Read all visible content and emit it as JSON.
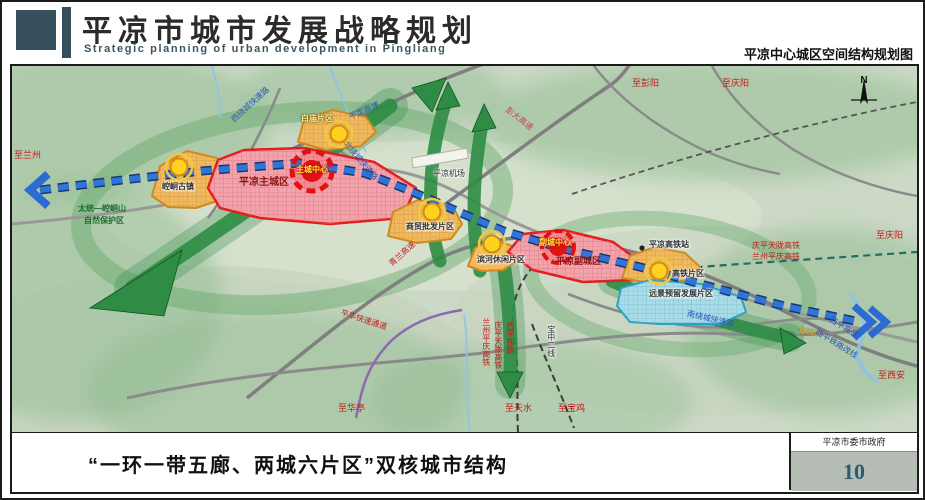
{
  "header": {
    "title": "平凉市城市发展战略规划",
    "subtitle": "Strategic planning of urban development in Pingliang",
    "map_title": "平凉中心城区空间结构规划图"
  },
  "footer": {
    "caption": "“一环一带五廊、两城六片区”双核城市结构",
    "authority": "平凉市委市政府",
    "page_number": "10"
  },
  "map": {
    "compass": "N",
    "labels": {
      "to_lanzhou": "至兰州",
      "nature_reserve_1": "太统—崆峒山",
      "nature_reserve_2": "自然保护区",
      "kongtong_zone": "崆峒古镇",
      "main_city": "平凉主城区",
      "main_center": "主城中心",
      "baimiao_zone": "白庙片区",
      "west_ring_rd": "西绕城快速路",
      "pingding_expwy": "平定高速",
      "pengda_expwy": "彭大高速",
      "to_pengyang": "至彭阳",
      "to_qingyang_top": "至庆阳",
      "airport": "平凉机场",
      "north_ring_rd": "北绕城快速路",
      "trade_zone": "商贸批发片区",
      "qinglan_expwy": "青兰高速",
      "leisure_zone": "滨河休闲片区",
      "sub_city": "平凉副城区",
      "sub_center": "副城中心",
      "hsr_station": "平凉高铁站",
      "qptl_hsr": "庆平天陇高铁",
      "lzpq_hsr": "兰州平庆高铁",
      "to_qingyang_right": "至庆阳",
      "hsr_zone": "高铁片区",
      "reserved_zone": "远景预留发展片区",
      "south_ring_rd": "南绕城快速路",
      "pinghua_rd": "平华快速通道",
      "to_huating": "至华亭",
      "lzpq_hsr_v": "兰州平庆高铁",
      "qptl_hsr_v": "庆平天陇高铁",
      "xiping_rail_v": "西平铁路",
      "baozhong_line": "宝中二线",
      "to_tianshui": "至天水",
      "to_baoji": "至宝鸡",
      "g312": "G312",
      "xiping_expwy": "西平高速",
      "xiping_rail_reroute": "西平铁路改线",
      "to_xian": "至西安"
    },
    "colors": {
      "accent_teal": "#35505c",
      "corridor_green": "#2e8c44",
      "transit_blue": "#2f74d6",
      "city_red": "#e31c1c",
      "district_orange": "#f0b95e",
      "reserved_blue": "#aadce8",
      "center_yellow": "#ffd21f"
    }
  }
}
